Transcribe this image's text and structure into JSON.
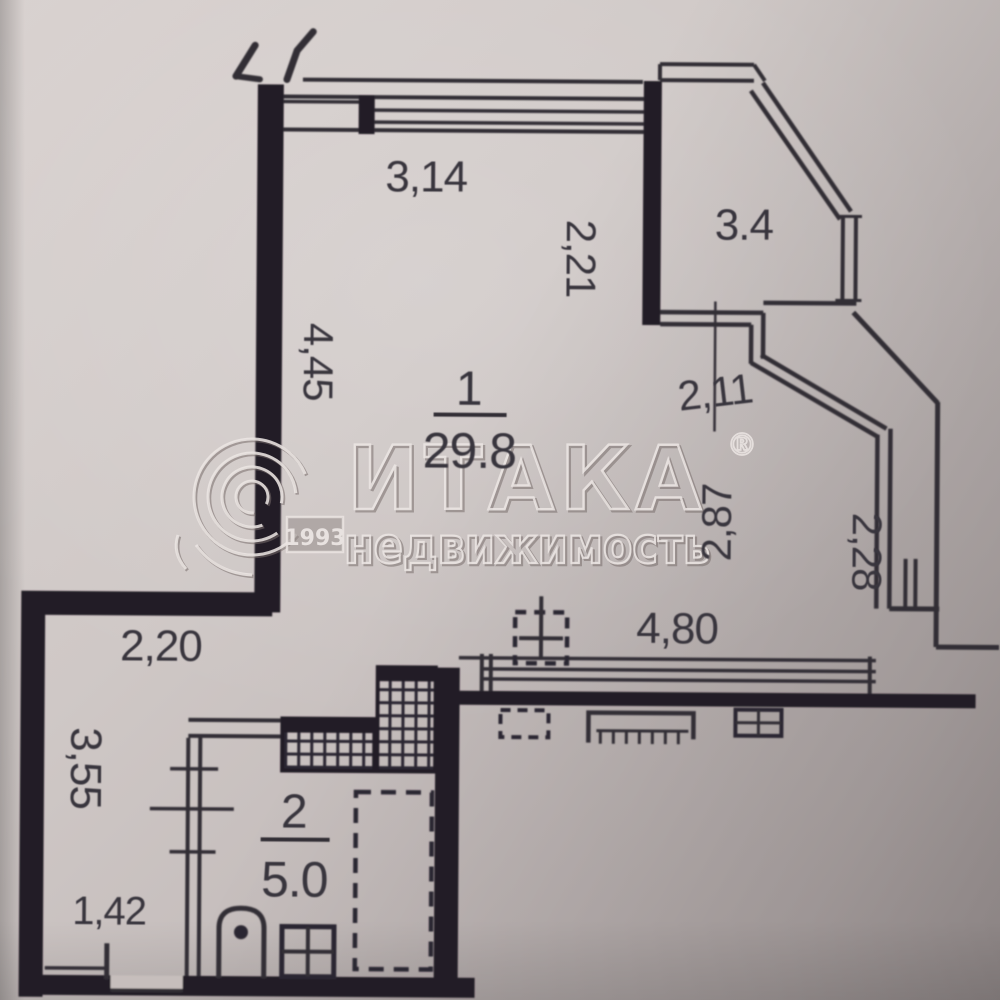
{
  "document": {
    "type": "floor-plan-scan"
  },
  "rooms": {
    "living": {
      "number": "1",
      "area": "29.8"
    },
    "bath": {
      "number": "2",
      "area": "5.0"
    }
  },
  "dims": {
    "w314": "3,14",
    "w34": "3.4",
    "w221": "2,21",
    "w445": "4,45",
    "w211": "2,11",
    "w287": "2,87",
    "w228": "2,28",
    "w480": "4,80",
    "w220": "2,20",
    "w355": "3,55",
    "w142": "1,42"
  },
  "watermark": {
    "brand": "ИТАКА",
    "reg": "®",
    "year": "1993",
    "line2": "недвижимость"
  }
}
